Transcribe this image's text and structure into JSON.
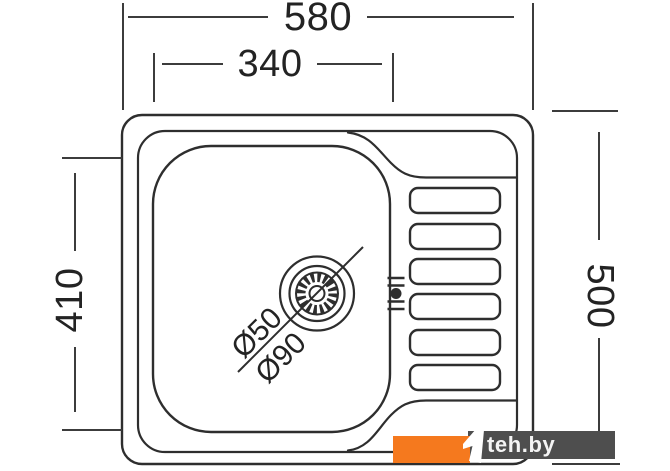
{
  "dimensions": {
    "overall_width": "580",
    "bowl_width": "340",
    "bowl_depth": "410",
    "overall_depth": "500"
  },
  "drain": {
    "waste_diameter": "Ø50",
    "flange_diameter": "Ø90"
  },
  "watermark": {
    "label": "teh.by",
    "accent_color": "#F5791E",
    "panel_color": "#4E4E4E",
    "glyph_color": "#FFFFFF"
  },
  "colors": {
    "background": "#FFFFFF",
    "drawing_line": "#2E2E2E",
    "dimension_line": "#3C3C3C"
  }
}
